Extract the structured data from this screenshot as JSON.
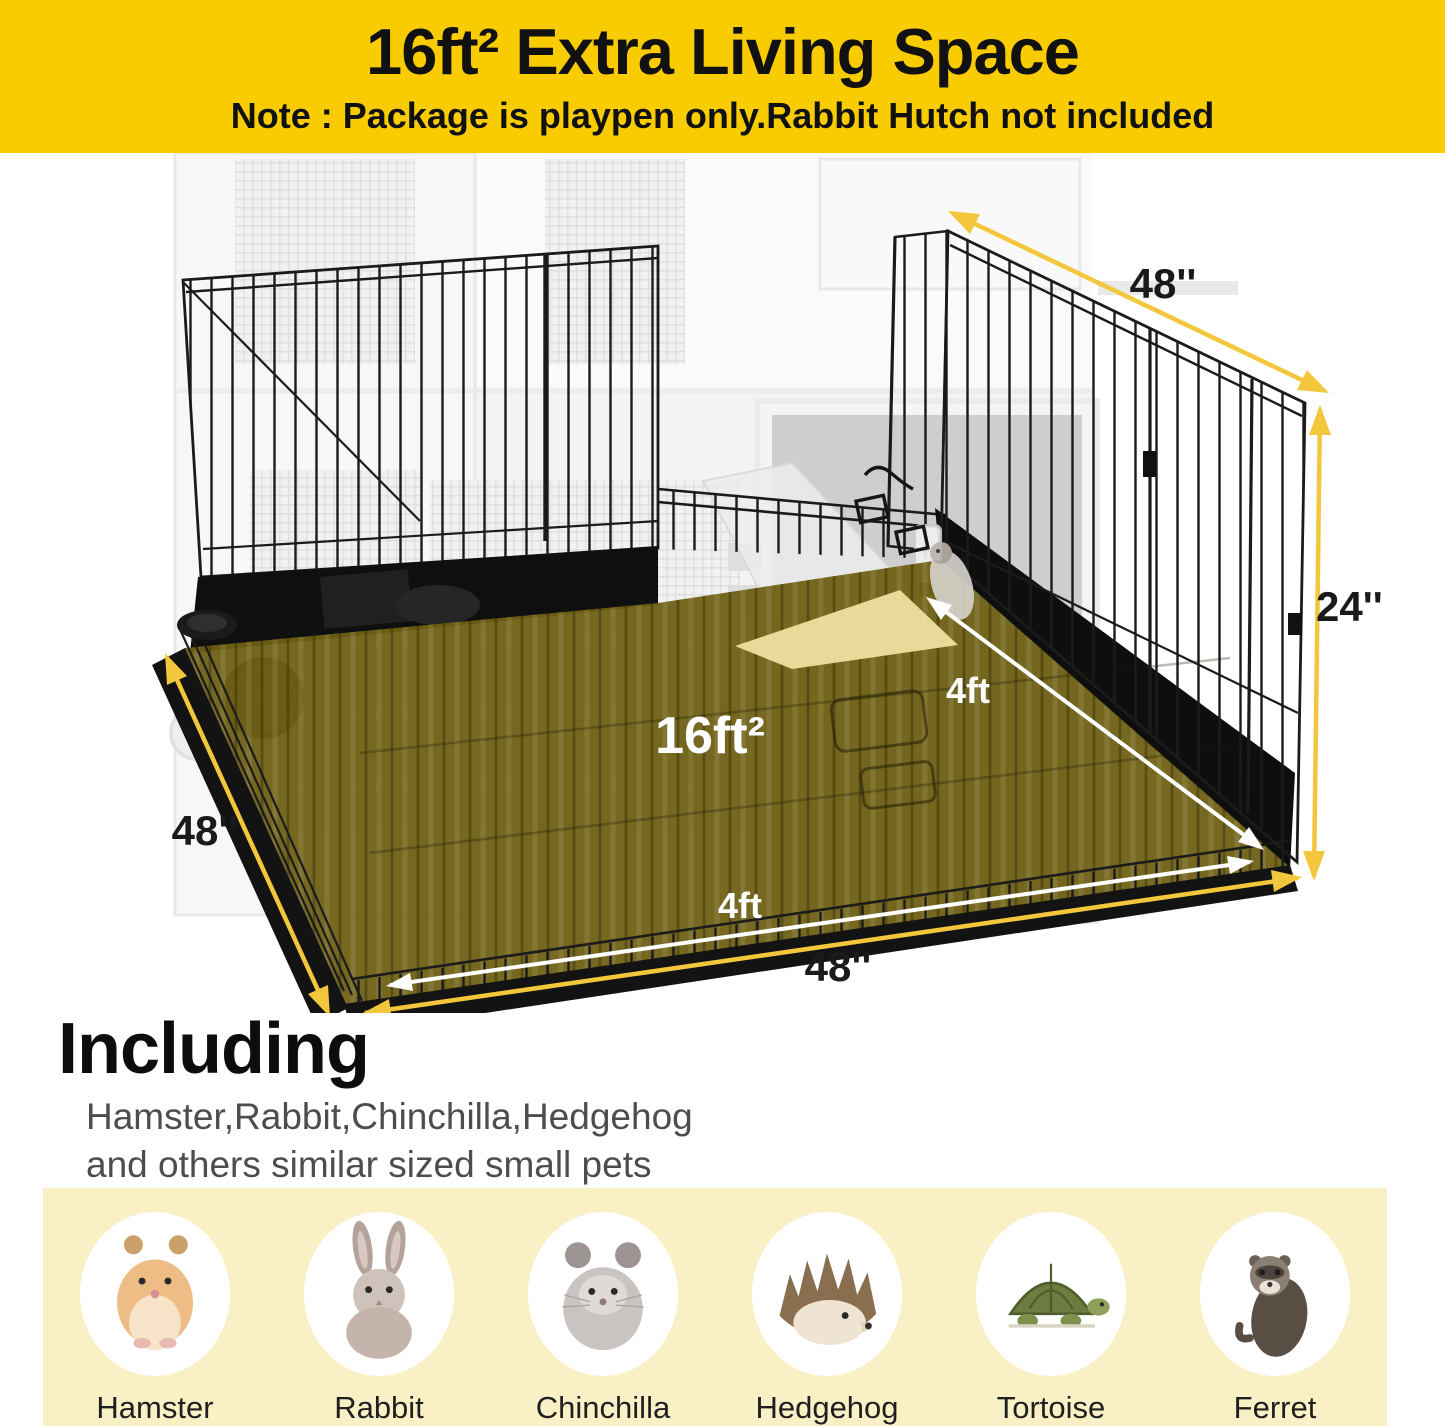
{
  "header": {
    "title": "16ft² Extra Living Space",
    "note": "Note : Package is playpen only.Rabbit Hutch not included"
  },
  "diagram": {
    "area_label": "16ft²",
    "top_width_label": "48''",
    "right_height_label": "24''",
    "left_depth_label": "48''",
    "bottom_width_label": "48''",
    "floor_width_label": "4ft",
    "floor_depth_label": "4ft"
  },
  "including": {
    "heading": "Including",
    "line1": "Hamster,Rabbit,Chinchilla,Hedgehog",
    "line2": "and others similar sized small pets"
  },
  "pets": [
    {
      "name": "Hamster"
    },
    {
      "name": "Rabbit"
    },
    {
      "name": "Chinchilla"
    },
    {
      "name": "Hedgehog"
    },
    {
      "name": "Tortoise"
    },
    {
      "name": "Ferret"
    }
  ],
  "colors": {
    "header_bg": "#F8CC00",
    "arrow_yellow": "#F3C73B",
    "floor_highlight": "#6F6014",
    "ramp_highlight": "#F2E5A5",
    "band_bg": "#FAF0C6"
  }
}
